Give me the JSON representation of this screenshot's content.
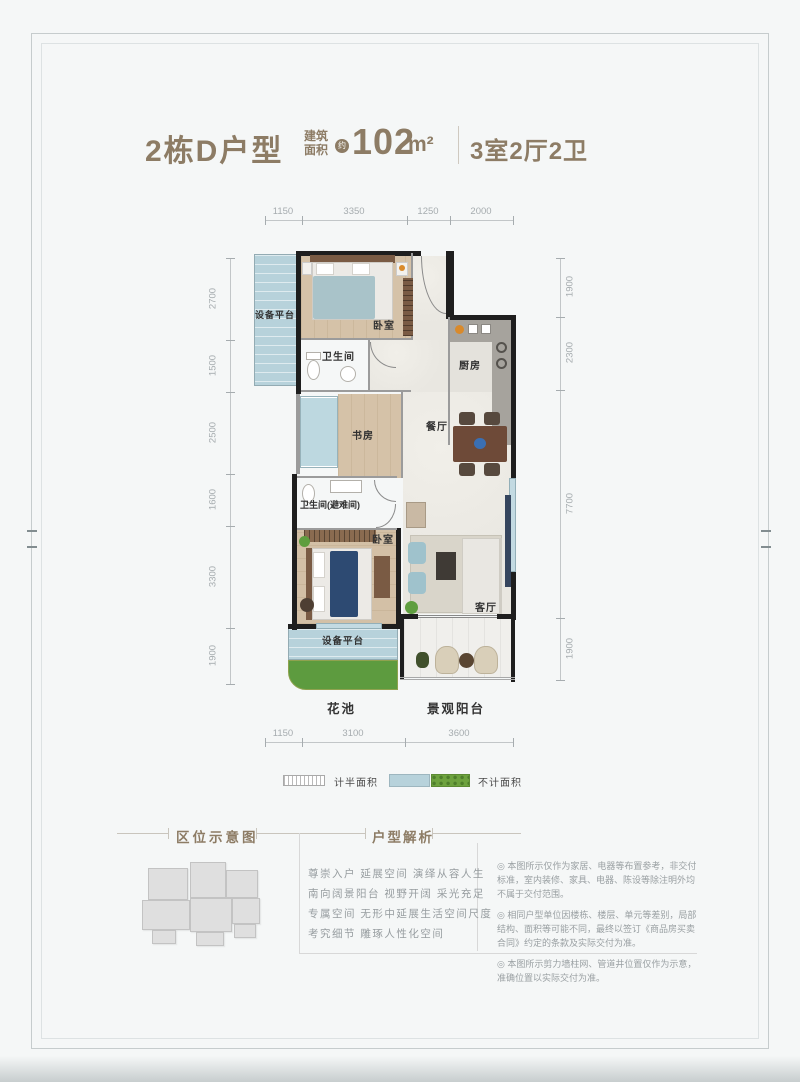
{
  "header": {
    "plan_name": "2栋D户型",
    "area_prefix_1": "建筑",
    "area_prefix_2": "面积",
    "approx": "约",
    "area_value": "102",
    "area_unit": "m²",
    "rooms_summary": "3室2厅2卫"
  },
  "plan": {
    "dims": {
      "top": [
        "1150",
        "3350",
        "1250",
        "2000"
      ],
      "bottom": [
        "1150",
        "3100",
        "3600"
      ],
      "left": [
        "2700",
        "1500",
        "2500",
        "1600",
        "3300",
        "1900"
      ],
      "right": [
        "1900",
        "2300",
        "7700",
        "1900"
      ]
    },
    "rooms": {
      "equip_top": "设备平台",
      "bedroom_top": "卧室",
      "bath_top": "卫生间",
      "kitchen": "厨房",
      "study": "书房",
      "dining": "餐厅",
      "bath_mid": "卫生间(避难间)",
      "bedroom_bottom": "卧室",
      "living": "客厅",
      "equip_bottom": "设备平台",
      "flower_bed": "花池",
      "balcony": "景观阳台"
    },
    "legend": {
      "half_area": "计半面积",
      "no_area": "不计面积"
    }
  },
  "sections": {
    "location_title": "区位示意图",
    "analysis_title": "户型解析",
    "analysis_lines": [
      "尊崇入户 延展空间 演绎从容人生",
      "南向阔景阳台 视野开阔 采光充足",
      "专属空间 无形中延展生活空间尺度",
      "考究细节 雕琢人性化空间"
    ],
    "disclaimers": [
      "◎ 本图所示仅作为家居、电器等布置参考，非交付标准，室内装修、家具、电器、陈设等除注明外均不属于交付范围。",
      "◎ 相同户型单位因楼栋、楼层、单元等差别，局部结构、面积等可能不同，最终以签订《商品房买卖合同》约定的条款及实际交付为准。",
      "◎ 本图所示剪力墙柱网、管道井位置仅作为示意，准确位置以实际交付为准。"
    ]
  },
  "colors": {
    "accent": "#8d7c65",
    "wall": "#1e1e1e",
    "window_blue": "#b7d2db",
    "wood_floor": "#d5c2a8",
    "flower_green": "#5d9b3f"
  }
}
